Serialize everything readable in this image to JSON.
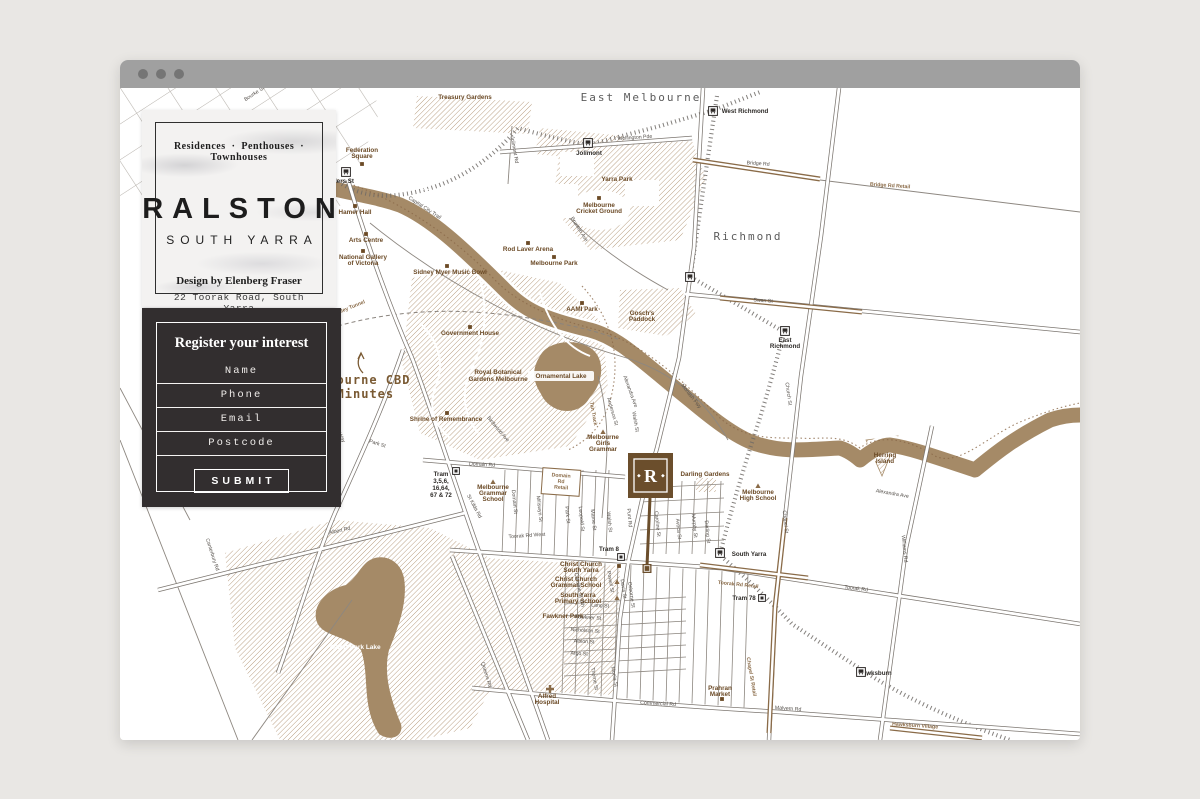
{
  "browser": {
    "window_controls": [
      "close",
      "minimize",
      "maximize"
    ]
  },
  "brand_card": {
    "tagline": "Residences · Penthouses · Townhouses",
    "title": "RALSTON",
    "subtitle": "SOUTH YARRA",
    "designer": "Design by Elenberg Fraser",
    "address": "22 Toorak Road, South Yarra"
  },
  "form": {
    "heading": "Register your interest",
    "fields": [
      {
        "name": "name",
        "placeholder": "Name"
      },
      {
        "name": "phone",
        "placeholder": "Phone"
      },
      {
        "name": "email",
        "placeholder": "Email"
      },
      {
        "name": "postcode",
        "placeholder": "Postcode"
      }
    ],
    "submit_label": "SUBMIT"
  },
  "map": {
    "colors": {
      "river": "#a58a67",
      "hatch": "#b49879",
      "brown_road": "#8a6b48",
      "poi_label": "#6b4a26",
      "road_casing": "#7b756f",
      "rail": "#6e6a66",
      "suburb_label": "#5c5c5c",
      "marker_brown": "#6b4e2c"
    },
    "marker": {
      "letter": "R"
    },
    "annotation": {
      "line1": "Melbourne CBD",
      "line2": "10 Minutes"
    },
    "labels": [
      [
        "East Melbourne",
        521,
        13,
        0,
        "suburb"
      ],
      [
        "Richmond",
        628,
        152,
        0,
        "suburb"
      ],
      [
        "Melbourne CBD",
        237,
        296,
        0,
        "cbd"
      ],
      [
        "10 Minutes",
        233,
        310,
        0,
        "cbd"
      ],
      [
        "Yarra River",
        313,
        108,
        33,
        "riv"
      ],
      [
        "Albert Park Lake",
        235,
        561,
        0,
        "lake"
      ],
      [
        "Treasury Gardens",
        345,
        11,
        0,
        "poi"
      ],
      [
        "Federation",
        242,
        64,
        0,
        "poi"
      ],
      [
        "Square",
        242,
        70,
        0,
        "poi"
      ],
      [
        "Hamer Hall",
        235,
        126,
        0,
        "poi"
      ],
      [
        "Arts Centre",
        246,
        154,
        0,
        "poi"
      ],
      [
        "National Gallery",
        243,
        171,
        0,
        "poi"
      ],
      [
        "of Victoria",
        243,
        177,
        0,
        "poi"
      ],
      [
        "Sidney Myer Music Bowl",
        330,
        186,
        0,
        "poi"
      ],
      [
        "Rod Laver Arena",
        408,
        163,
        0,
        "poi"
      ],
      [
        "Melbourne Park",
        434,
        177,
        0,
        "poi"
      ],
      [
        "Jolimont",
        469,
        67,
        0,
        "stn"
      ],
      [
        "West Richmond",
        625,
        25,
        0,
        "stn"
      ],
      [
        "Flinders St",
        218,
        95,
        0,
        "stn"
      ],
      [
        "Yarra Park",
        497,
        93,
        0,
        "poi"
      ],
      [
        "Melbourne",
        479,
        119,
        0,
        "poi"
      ],
      [
        "Cricket Ground",
        479,
        125,
        0,
        "poi"
      ],
      [
        "Gosch's",
        522,
        227,
        0,
        "poi"
      ],
      [
        "Paddock",
        522,
        233,
        0,
        "poi"
      ],
      [
        "AAMI Park",
        462,
        223,
        0,
        "poi"
      ],
      [
        "Government House",
        350,
        247,
        0,
        "poi"
      ],
      [
        "Royal Botanical",
        378,
        286,
        0,
        "poi"
      ],
      [
        "Gardens Melbourne",
        378,
        293,
        0,
        "poi"
      ],
      [
        "Ornamental Lake",
        441,
        290,
        0,
        "poi"
      ],
      [
        "Shrine of Remembrance",
        326,
        333,
        0,
        "poi"
      ],
      [
        "Melbourne",
        483,
        351,
        0,
        "poi"
      ],
      [
        "Girls",
        483,
        357,
        0,
        "poi"
      ],
      [
        "Grammar",
        483,
        363,
        0,
        "poi"
      ],
      [
        "Darling Gardens",
        585,
        388,
        0,
        "poi"
      ],
      [
        "Melbourne",
        638,
        406,
        0,
        "poi"
      ],
      [
        "High School",
        638,
        412,
        0,
        "poi"
      ],
      [
        "East",
        665,
        254,
        0,
        "stn"
      ],
      [
        "Richmond",
        665,
        260,
        0,
        "stn"
      ],
      [
        "South Yarra",
        629,
        468,
        0,
        "stn"
      ],
      [
        "Christ Church",
        461,
        478,
        0,
        "poi"
      ],
      [
        "South Yarra",
        461,
        484,
        0,
        "poi"
      ],
      [
        "Christ Church",
        456,
        493,
        0,
        "poi"
      ],
      [
        "Grammar School",
        456,
        499,
        0,
        "poi"
      ],
      [
        "South Yarra",
        458,
        509,
        0,
        "poi"
      ],
      [
        "Primary School",
        458,
        515,
        0,
        "poi"
      ],
      [
        "Fawkner Park",
        443,
        530,
        0,
        "poi"
      ],
      [
        "Alfred",
        427,
        610,
        0,
        "poi"
      ],
      [
        "Hospital",
        427,
        616,
        0,
        "poi"
      ],
      [
        "Prahran",
        600,
        602,
        0,
        "poi"
      ],
      [
        "Market",
        600,
        608,
        0,
        "poi"
      ],
      [
        "Hawksburn",
        755,
        587,
        0,
        "stn"
      ],
      [
        "Hawksburn Village",
        795,
        639,
        4,
        "sbr"
      ],
      [
        "Tram 8",
        489,
        463,
        0,
        "stn"
      ],
      [
        "Tram 78",
        624,
        512,
        0,
        "stn"
      ],
      [
        "Tram",
        321,
        388,
        0,
        "stn"
      ],
      [
        "3,5,6,",
        321,
        395,
        0,
        "stn"
      ],
      [
        "16,64,",
        321,
        402,
        0,
        "stn"
      ],
      [
        "67 & 72",
        321,
        409,
        0,
        "stn"
      ],
      [
        "Melbourne",
        373,
        401,
        0,
        "poi"
      ],
      [
        "Grammar",
        373,
        407,
        0,
        "poi"
      ],
      [
        "School",
        373,
        413,
        0,
        "poi"
      ],
      [
        "Domain",
        441,
        389,
        4,
        "sbr"
      ],
      [
        "Rd",
        441,
        395,
        4,
        "sbr"
      ],
      [
        "Retail",
        441,
        401,
        4,
        "sbr"
      ],
      [
        "Herring",
        765,
        369,
        0,
        "poi"
      ],
      [
        "Island",
        765,
        375,
        0,
        "poi"
      ],
      [
        "Bourke St",
        135,
        7,
        -33,
        "street"
      ],
      [
        "Wellington Pde",
        515,
        51,
        -4,
        "street"
      ],
      [
        "Bridge Rd",
        638,
        77,
        4,
        "street"
      ],
      [
        "Bridge Rd Retail",
        770,
        99,
        4,
        "sbr"
      ],
      [
        "Swan St",
        643,
        214,
        4,
        "street"
      ],
      [
        "Brunton Ave",
        458,
        142,
        58,
        "street"
      ],
      [
        "Jolimont Rd",
        393,
        62,
        80,
        "street"
      ],
      [
        "Capital City Trail",
        304,
        121,
        33,
        "street"
      ],
      [
        "Church St",
        667,
        306,
        82,
        "street"
      ],
      [
        "Chapel St",
        664,
        434,
        84,
        "street"
      ],
      [
        "Chapel St Retail",
        630,
        589,
        80,
        "sbr"
      ],
      [
        "Monash Fwy",
        570,
        309,
        52,
        "street"
      ],
      [
        "Alexandra Ave",
        509,
        304,
        70,
        "street"
      ],
      [
        "Alexandra Ave",
        772,
        407,
        10,
        "street"
      ],
      [
        "Punt Rd",
        508,
        430,
        85,
        "street"
      ],
      [
        "Toorak Rd West",
        407,
        449,
        -4,
        "street"
      ],
      [
        "Toorak Rd",
        736,
        502,
        7,
        "street"
      ],
      [
        "Toorak Rd Retail",
        618,
        498,
        6,
        "sbr"
      ],
      [
        "Commercial Rd",
        538,
        617,
        3,
        "street"
      ],
      [
        "Malvern Rd",
        668,
        622,
        4,
        "street"
      ],
      [
        "Domain Rd",
        362,
        378,
        3,
        "street"
      ],
      [
        "St Kilda Rd",
        353,
        419,
        62,
        "street"
      ],
      [
        "Albert Rd",
        220,
        444,
        -13,
        "street"
      ],
      [
        "Canterbury Rd",
        91,
        467,
        72,
        "street"
      ],
      [
        "Queens Rd",
        365,
        587,
        73,
        "street"
      ],
      [
        "Kings Way",
        217,
        344,
        62,
        "street"
      ],
      [
        "Williams Rd",
        783,
        461,
        84,
        "street"
      ],
      [
        "Park St",
        446,
        427,
        84,
        "street"
      ],
      [
        "Leopold St",
        460,
        431,
        84,
        "street"
      ],
      [
        "Marne St",
        472,
        432,
        84,
        "street"
      ],
      [
        "Walsh St",
        488,
        434,
        84,
        "street"
      ],
      [
        "Walsh St",
        514,
        334,
        80,
        "street"
      ],
      [
        "Anderson St",
        491,
        324,
        74,
        "street"
      ],
      [
        "Caroline St",
        536,
        436,
        84,
        "street"
      ],
      [
        "Avoca St",
        557,
        441,
        84,
        "street"
      ],
      [
        "Murphy St",
        573,
        438,
        84,
        "street"
      ],
      [
        "Darling St",
        586,
        444,
        84,
        "street"
      ],
      [
        "Osborne St",
        510,
        507,
        82,
        "street"
      ],
      [
        "Davis St",
        502,
        501,
        82,
        "street"
      ],
      [
        "Powell St",
        489,
        494,
        80,
        "street"
      ],
      [
        "Caroline St Sth",
        458,
        502,
        78,
        "street"
      ],
      [
        "Lang St",
        480,
        519,
        4,
        "street"
      ],
      [
        "Fawkner St",
        468,
        531,
        4,
        "street"
      ],
      [
        "Nicholson St",
        465,
        544,
        4,
        "street"
      ],
      [
        "Albion St",
        464,
        555,
        3,
        "street"
      ],
      [
        "Argo St",
        459,
        567,
        3,
        "street"
      ],
      [
        "Thorne St",
        473,
        591,
        80,
        "street"
      ],
      [
        "Moola St",
        493,
        589,
        80,
        "street"
      ],
      [
        "Tan Track",
        472,
        326,
        80,
        "sbr"
      ],
      [
        "Birdwood Ave",
        377,
        342,
        50,
        "street"
      ],
      [
        "Burnley Tunnel",
        228,
        222,
        -22,
        "sbr"
      ],
      [
        "Domain St",
        393,
        414,
        84,
        "street"
      ],
      [
        "Millswyn St",
        418,
        421,
        84,
        "street"
      ],
      [
        "Park St",
        257,
        357,
        18,
        "street"
      ]
    ],
    "markers": {
      "squares": [
        [
          242,
          76
        ],
        [
          235,
          118
        ],
        [
          246,
          146
        ],
        [
          243,
          163
        ],
        [
          327,
          178
        ],
        [
          408,
          155
        ],
        [
          434,
          169
        ],
        [
          479,
          110
        ],
        [
          350,
          239
        ],
        [
          327,
          325
        ],
        [
          499,
          478
        ],
        [
          602,
          611
        ],
        [
          462,
          215
        ]
      ],
      "triangles": [
        [
          483,
          344
        ],
        [
          373,
          394
        ],
        [
          638,
          398
        ],
        [
          497,
          494
        ],
        [
          497,
          510
        ]
      ],
      "stations": [
        [
          226,
          84
        ],
        [
          468,
          55
        ],
        [
          593,
          23
        ],
        [
          570,
          189
        ],
        [
          665,
          243
        ],
        [
          600,
          465
        ],
        [
          741,
          584
        ]
      ],
      "trams": [
        [
          501,
          469
        ],
        [
          642,
          510
        ],
        [
          336,
          383
        ]
      ],
      "hospital_cross": [
        430,
        601
      ]
    }
  }
}
